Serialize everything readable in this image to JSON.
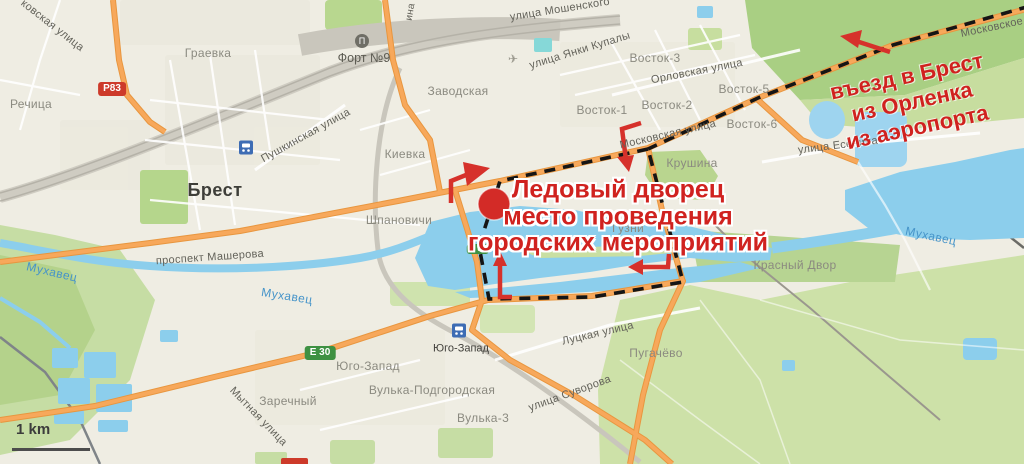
{
  "annotations": {
    "venue": {
      "lines": [
        "Ледовый дворец",
        "место проведения",
        "городских мероприятий"
      ],
      "color": "#d0221f"
    },
    "entry": {
      "lines": [
        "въезд в Брест",
        "из Орленка",
        "из аэропорта"
      ],
      "color": "#d0221f"
    }
  },
  "labels": {
    "city": {
      "text": "Брест"
    },
    "districts": [
      {
        "text": "Граевка"
      },
      {
        "text": "Речица"
      },
      {
        "text": "Киевка"
      },
      {
        "text": "Шпановичи"
      },
      {
        "text": "Заводская"
      },
      {
        "text": "Восток-1"
      },
      {
        "text": "Восток-2"
      },
      {
        "text": "Восток-3"
      },
      {
        "text": "Восток-5"
      },
      {
        "text": "Восток-6"
      },
      {
        "text": "Крушина"
      },
      {
        "text": "Гузни"
      },
      {
        "text": "Красный Двор"
      },
      {
        "text": "Пугачёво"
      },
      {
        "text": "Юго-Запад"
      },
      {
        "text": "Заречный"
      },
      {
        "text": "Вулька-Подгородская"
      },
      {
        "text": "Вулька-3"
      }
    ],
    "streets": [
      {
        "text": "ковская улица"
      },
      {
        "text": "Пушкинская улица"
      },
      {
        "text": "улица Мошенского"
      },
      {
        "text": "улица Янки Купалы"
      },
      {
        "text": "Орловская улица"
      },
      {
        "text": "Московская улица"
      },
      {
        "text": "Московское"
      },
      {
        "text": "улица Есенина"
      },
      {
        "text": "Луцкая улица"
      },
      {
        "text": "улица Суворова"
      },
      {
        "text": "Мытная улица"
      },
      {
        "text": "проспект Машерова"
      },
      {
        "text": "ина"
      }
    ],
    "water": [
      {
        "text": "Мухавец"
      },
      {
        "text": "Мухавец"
      },
      {
        "text": "Мухавец"
      }
    ],
    "stations": [
      {
        "text": "Юго-Запад"
      }
    ],
    "pois": [
      {
        "text": "Форт №9"
      }
    ]
  },
  "badges": {
    "p83": {
      "label": "Р83"
    },
    "e30": {
      "label": "Е 30"
    },
    "e30_small": {
      "label": "Е 30"
    }
  },
  "scale": {
    "label": "1 km"
  },
  "icons": {
    "museum_glyph": "Π",
    "airplane_glyph": "✈"
  },
  "colors": {
    "annotation_red": "#d0221f",
    "route_dash": "#151515",
    "water": "#8cceec",
    "forest": "#a9cf83",
    "green": "#c8dda1",
    "road_orange": "#f7a85b",
    "badge_green": "#3e9142",
    "badge_red": "#cd3a2a"
  }
}
